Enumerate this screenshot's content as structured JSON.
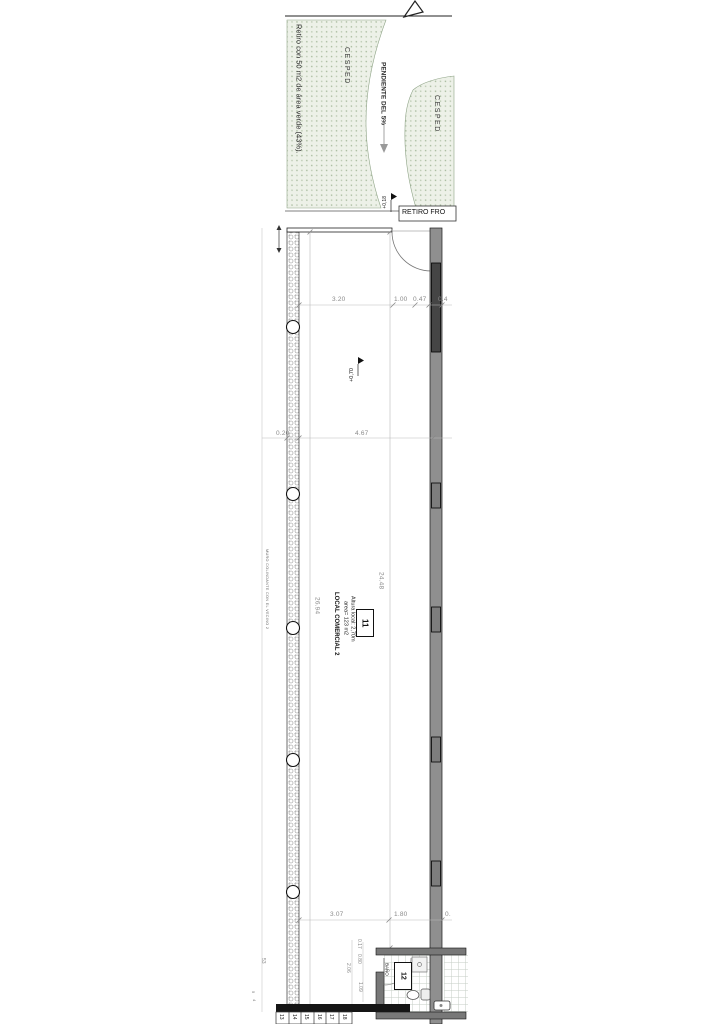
{
  "site": {
    "note": "Retiro con 50 m2 de área verde (43%).",
    "grass_left": "CESPED",
    "grass_right": "CESPED",
    "slope": "PENDIENTE DEL 5%",
    "entry_level": "+0,18",
    "front_setback": "RETIRO FRO"
  },
  "unit": {
    "number": "11",
    "name": "LOCAL COMERCIAL 2",
    "area": "area= 123 m2",
    "height": "Altura local: 2,70m",
    "floor_level": "+0,70",
    "wall_note": "MURO COLINDANTE CON EL VECINO 2"
  },
  "bathroom": {
    "number": "12",
    "label": "BAÑO"
  },
  "dims": {
    "top": [
      "3.20",
      "1.00",
      "0.47",
      "0.4"
    ],
    "mid": [
      "0.20",
      "4.67"
    ],
    "length_left": "26.94",
    "length_right": "24.48",
    "bottom": [
      "3.07",
      "1.80",
      "0."
    ],
    "bath": [
      "0.17",
      "0.80",
      "2.06",
      "1.09"
    ],
    "side": "53"
  },
  "stairs": {
    "treads": [
      "13",
      "14",
      "15",
      "16",
      "17",
      "18"
    ],
    "side": [
      "5",
      "4"
    ]
  },
  "colors": {
    "wall_gray": "#8f8f8f",
    "glazing_dark": "#454545",
    "grass_fill": "#edf1e8",
    "grass_dot": "#a3b798",
    "dim_gray": "#8a8a8a"
  }
}
